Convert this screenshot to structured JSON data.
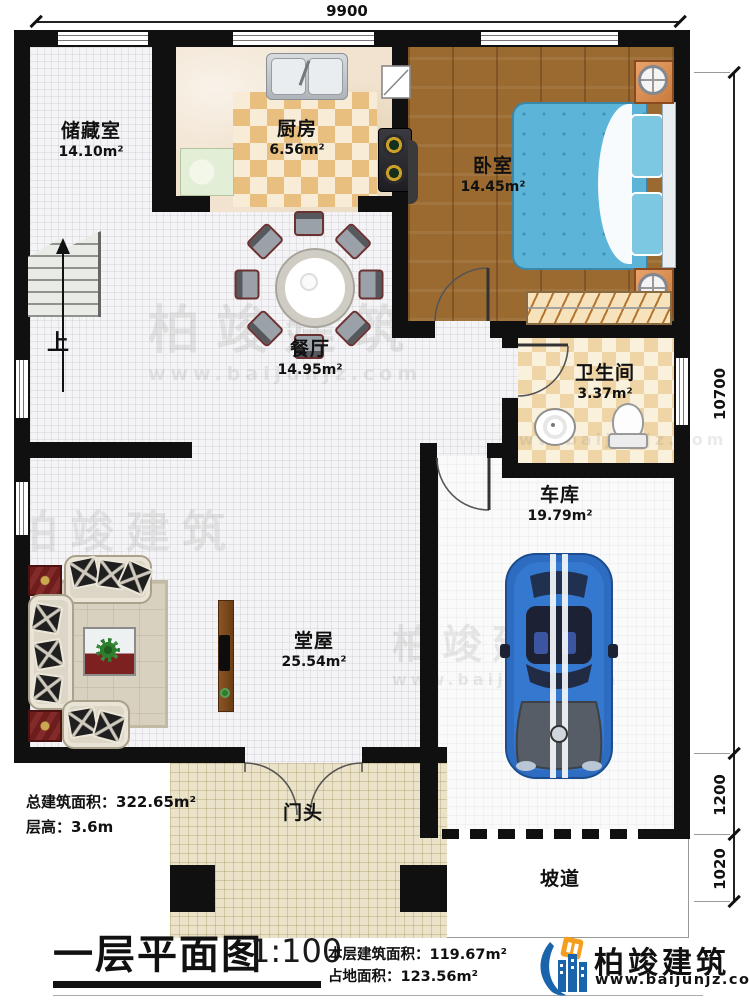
{
  "plan": {
    "dimensions": {
      "width_top": "9900",
      "height_total": "10700",
      "height_mid": "1200",
      "height_low": "1020"
    },
    "rooms": {
      "storage": {
        "name": "储藏室",
        "area": "14.10m²"
      },
      "kitchen": {
        "name": "厨房",
        "area": "6.56m²"
      },
      "bedroom": {
        "name": "卧室",
        "area": "14.45m²"
      },
      "dining": {
        "name": "餐厅",
        "area": "14.95m²"
      },
      "bathroom": {
        "name": "卫生间",
        "area": "3.37m²"
      },
      "garage": {
        "name": "车库",
        "area": "19.79m²"
      },
      "hall": {
        "name": "堂屋",
        "area": "25.54m²"
      },
      "porch": {
        "name": "门头"
      },
      "ramp": {
        "name": "坡道"
      },
      "stairs_up_label": "上"
    },
    "notes": {
      "total_area_label": "总建筑面积：",
      "total_area_value": "322.65m²",
      "floor_height_label": "层高：",
      "floor_height_value": "3.6m"
    },
    "title_block": {
      "title": "一层平面图",
      "scale": "1:100",
      "floor_area_label": "本层建筑面积：",
      "floor_area_value": "119.67m²",
      "footprint_label": "占地面积：",
      "footprint_value": "123.56m²"
    },
    "brand": {
      "name": "柏竣建筑",
      "website": "www.baijunjz.com"
    },
    "watermark": {
      "text": "柏竣建筑",
      "website": "www.baijunjz.com"
    },
    "colors": {
      "wall": "#101010",
      "wood_floor": "#9b6a30",
      "bed_blue": "#5cb5d8",
      "brand_blue": "#1a64ab",
      "brand_orange": "#f59d1c"
    }
  }
}
